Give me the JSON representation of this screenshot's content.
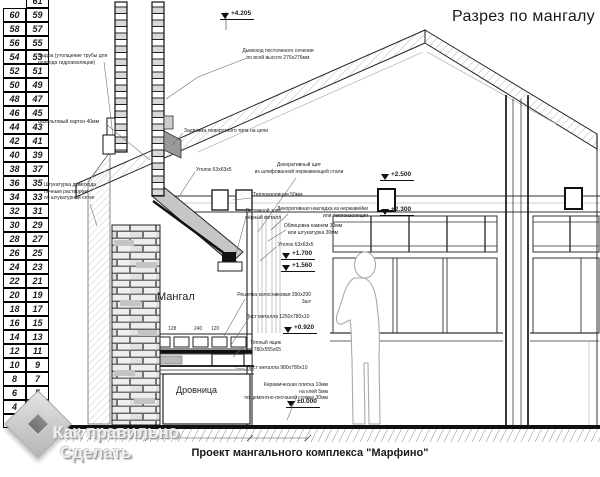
{
  "title": "Разрез по мангалу",
  "caption": "Проект мангального комплекса \"Марфино\"",
  "watermark": {
    "line1": "Как правильно",
    "line2": "Сделать"
  },
  "colors": {
    "line": "#1a1a1a",
    "brick_light": "#f2f2f2",
    "hood_gray": "#c6c6c6",
    "watermark_gray": "#c9c9c9"
  },
  "ruler": {
    "left": [
      60,
      58,
      56,
      54,
      52,
      50,
      48,
      46,
      44,
      42,
      40,
      38,
      36,
      34,
      32,
      30,
      28,
      26,
      24,
      22,
      20,
      18,
      16,
      14,
      12,
      10,
      8,
      6,
      4,
      2
    ],
    "right": [
      61,
      59,
      57,
      55,
      53,
      51,
      49,
      47,
      45,
      43,
      41,
      39,
      37,
      35,
      33,
      31,
      29,
      27,
      25,
      23,
      21,
      19,
      17,
      15,
      13,
      11,
      9,
      7,
      5,
      3,
      1
    ]
  },
  "annotations": [
    {
      "id": "vydra",
      "text": "Выдра (утолщение трубы для\nподвода гидроизоляции)",
      "x": 38,
      "y": 53,
      "align": "l",
      "size": 5
    },
    {
      "id": "basalt",
      "text": "Базальтовый картон 40мм",
      "x": 38,
      "y": 119,
      "align": "l",
      "size": 5
    },
    {
      "id": "shtukaturka",
      "text": "Штукатурка дымохода\nпечным раствором\nпо штукатурной сетке",
      "x": 44,
      "y": 182,
      "align": "l",
      "size": 5
    },
    {
      "id": "dymohod",
      "text": "Дымоход постоянного сечения\nпо всей высоте 276х276мм",
      "x": 278,
      "y": 48,
      "align": "c",
      "size": 5
    },
    {
      "id": "zadvizhka",
      "text": "Задвижка поворотного типа на цепи",
      "x": 184,
      "y": 128,
      "align": "l",
      "size": 5
    },
    {
      "id": "ugolok-1",
      "text": "Уголок 63х63х5",
      "x": 196,
      "y": 167,
      "align": "l",
      "size": 5
    },
    {
      "id": "dekor-shchit",
      "text": "Декоративный щит\nиз шлифованной нержавеющей стали",
      "x": 299,
      "y": 162,
      "align": "c",
      "size": 5
    },
    {
      "id": "teploizolyatsiya",
      "text": "Теплоизоляция 50мм",
      "x": 253,
      "y": 192,
      "align": "l",
      "size": 5
    },
    {
      "id": "zont",
      "text": "Вытяжной зонт\nчёрный металл",
      "x": 281,
      "y": 208,
      "align": "r",
      "size": 5
    },
    {
      "id": "nakladka",
      "text": "Декоративная накладка из нержавейки\nили теплоизоляция",
      "x": 368,
      "y": 206,
      "align": "r",
      "size": 5
    },
    {
      "id": "oblitsovka",
      "text": "Облицовка камнем 30мм\nили штукатурка 30мм",
      "x": 313,
      "y": 223,
      "align": "c",
      "size": 5
    },
    {
      "id": "ugolok-2",
      "text": "Уголок 63х63х5",
      "x": 278,
      "y": 242,
      "align": "l",
      "size": 5
    },
    {
      "id": "mangal",
      "text": "Мангал",
      "x": 157,
      "y": 290,
      "align": "l",
      "size": 11
    },
    {
      "id": "reshetka",
      "text": "Решетка колосниковая 390х290\n3шт",
      "x": 311,
      "y": 292,
      "align": "r",
      "size": 5
    },
    {
      "id": "list-metalla-1",
      "text": "Лист металла 1250х780х10",
      "x": 246,
      "y": 314,
      "align": "l",
      "size": 5
    },
    {
      "id": "yashchik",
      "text": "Тёплый ящик\n780х555х65",
      "x": 281,
      "y": 340,
      "align": "r",
      "size": 5
    },
    {
      "id": "list-metalla-2",
      "text": "Лист металла 980х780х10",
      "x": 247,
      "y": 365,
      "align": "l",
      "size": 5
    },
    {
      "id": "plitka",
      "text": "Керамическая плитка 10мм\nна клей 5мм\nпо цементно-песчаной стяжке 30мм",
      "x": 328,
      "y": 382,
      "align": "r",
      "size": 5
    },
    {
      "id": "drovnitsa",
      "text": "Дровница",
      "x": 176,
      "y": 385,
      "align": "l",
      "size": 9
    }
  ],
  "levels": [
    {
      "text": "+4.205",
      "x": 220,
      "y": 10
    },
    {
      "text": "+2.500",
      "x": 380,
      "y": 171
    },
    {
      "text": "+2.300",
      "x": 380,
      "y": 206
    },
    {
      "text": "+1.700",
      "x": 281,
      "y": 250
    },
    {
      "text": "+1.560",
      "x": 281,
      "y": 262
    },
    {
      "text": "+0.920",
      "x": 283,
      "y": 324
    },
    {
      "text": "±0.000",
      "x": 286,
      "y": 398
    }
  ],
  "dims": [
    {
      "text": "128",
      "x": 168,
      "y": 326
    },
    {
      "text": "240",
      "x": 194,
      "y": 326
    },
    {
      "text": "120",
      "x": 211,
      "y": 326
    }
  ]
}
